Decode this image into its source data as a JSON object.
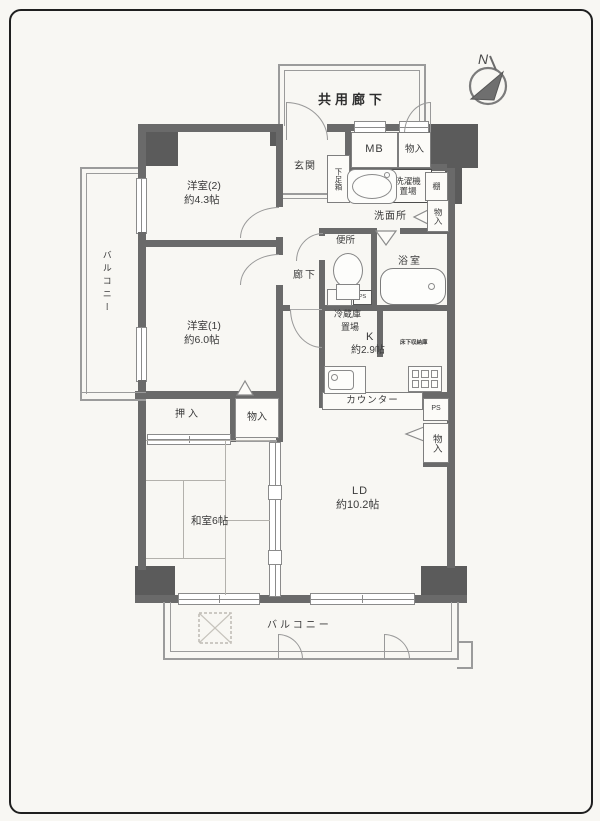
{
  "page": {
    "background": "#f8f7f3",
    "border_color": "#1f1f1f"
  },
  "labels": {
    "common_corridor": "共用廊下",
    "compass_n": "N",
    "room2_name": "洋室(2)",
    "room2_size": "約4.3帖",
    "room1_name": "洋室(1)",
    "room1_size": "約6.0帖",
    "entrance": "玄関",
    "shoe_box": "下足箱",
    "mb": "MB",
    "storage_corridor": "物入",
    "washer_line1": "洗濯機",
    "washer_line2": "置場",
    "shelf_top": "棚",
    "washroom": "洗面所",
    "storage_wash": "物入",
    "toilet": "便所",
    "bath": "浴室",
    "hallway": "廊下",
    "shelf_mid": "棚",
    "ps_small": "PS",
    "fridge_line1": "冷蔵庫",
    "fridge_line2": "置場",
    "kitchen_name": "K",
    "kitchen_size": "約2.9帖",
    "underfloor_storage": "床下収納庫",
    "counter": "カウンター",
    "ps_box": "PS",
    "storage_ld": "物入",
    "closet": "押入",
    "storage_mid": "物入",
    "japanese_room": "和室6帖",
    "ld_name": "LD",
    "ld_size": "約10.2帖",
    "balcony_left": "バルコニー",
    "balcony_bottom": "バルコニー"
  }
}
